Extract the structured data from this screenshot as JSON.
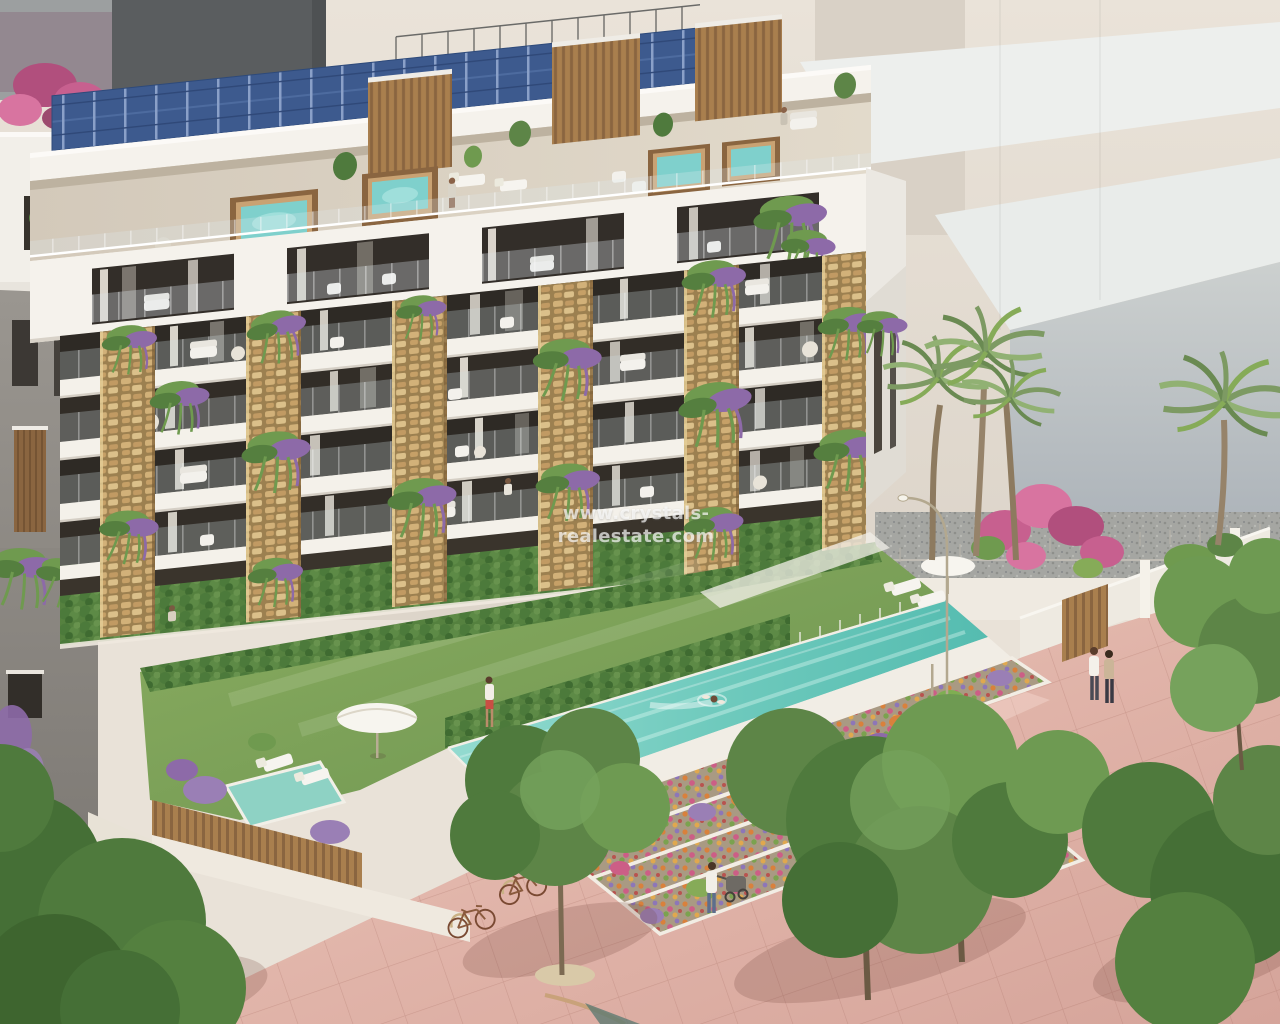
{
  "watermark": {
    "text": "www.crystals-realestate.com"
  },
  "scene": {
    "type": "3d-architectural-render",
    "subject": "Aerial render of a modern apartment residence with rooftop solar panels, jacuzzi roof terraces, stone-clad balcony piers, communal lap pool, lawn, terraced flower beds and a pink paved promenade",
    "elements": [
      "solar-panel-roof",
      "rooftop-jacuzzi-terraces",
      "balcony-facade",
      "stone-piers",
      "hanging-plants",
      "lap-pool",
      "swimmer",
      "lawn",
      "plunge-pool-garden",
      "flower-terraces",
      "pink-promenade",
      "palm-trees",
      "green-trees",
      "pedestrians",
      "bicycle-rack",
      "street-lamps",
      "background-buildings"
    ]
  },
  "palette": {
    "background_wall": "#e7e0d6",
    "dark_block": "#5a5d5f",
    "solar_panel": "#3d5a8e",
    "facade_white": "#f4f1ec",
    "stone_pier": "#c9a86b",
    "window_dark": "#2e2a25",
    "wood": "#a97f4e",
    "jacuzzi_water": "#7fd0cc",
    "lawn": "#7ea45c",
    "pool": "#6fcabd",
    "pink_pavement": "#e3bdb2",
    "tree_green": "#5d8547",
    "lavender": "#9a7fb5",
    "bougainvillea": "#c7608f",
    "watermark_color": "rgba(255,255,255,0.68)"
  }
}
